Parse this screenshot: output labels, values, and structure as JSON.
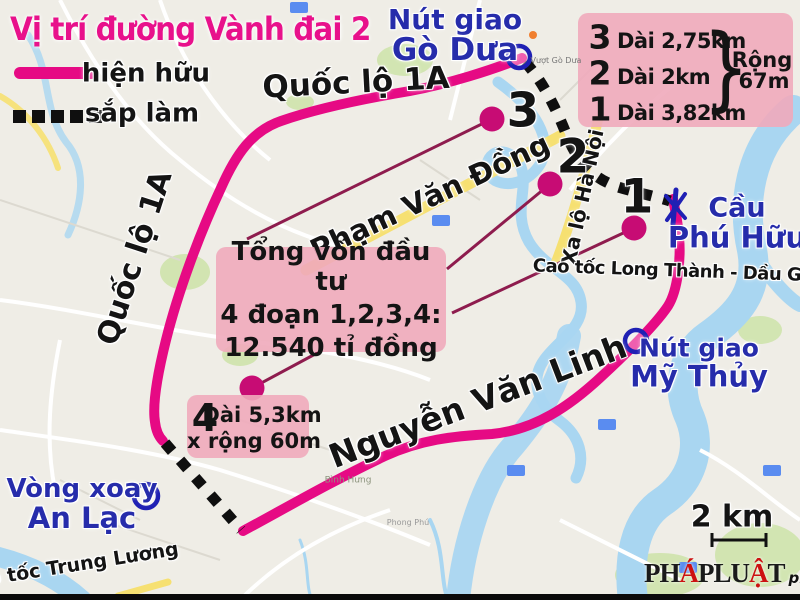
{
  "title": "Vị trí đường Vành đai 2",
  "legend": {
    "existing": "hiện hữu",
    "planned": "sắp làm"
  },
  "roads": {
    "ql1a_top": "Quốc lộ 1A",
    "ql1a_left": "Quốc lộ 1A",
    "pham_van_dong": "Phạm Văn Đồng",
    "xa_lo_ha_noi": "Xa lộ Hà Nội",
    "long_thanh": "Cao tốc Long Thành - Dầu Giây",
    "nguyen_van_linh": "Nguyễn Văn Linh",
    "trung_luong": "Cao tốc Trung Lương"
  },
  "junctions": {
    "go_dua": {
      "line1": "Nút giao",
      "line2": "Gò Dưa"
    },
    "my_thuy": {
      "line1": "Nút giao",
      "line2": "Mỹ Thủy"
    },
    "an_lac": {
      "line1": "Vòng xoay",
      "line2": "An Lạc"
    },
    "phu_huu": {
      "line1": "Cầu",
      "line2": "Phú Hữu"
    }
  },
  "segment_numbers": {
    "s1": "1",
    "s2": "2",
    "s3": "3"
  },
  "segment_box": {
    "rows": [
      {
        "num": "3",
        "len": "Dài 2,75km"
      },
      {
        "num": "2",
        "len": "Dài 2km"
      },
      {
        "num": "1",
        "len": "Dài 3,82km"
      }
    ],
    "brace": "}",
    "width_line1": "Rộng",
    "width_line2": "67m"
  },
  "investment_box": {
    "line1": "Tổng vốn đầu tư",
    "line2_a": "4 đoạn ",
    "line2_b": "1,2,3,4",
    "line2_c": ":",
    "line3": "12.540 tỉ đồng"
  },
  "segment4_box": {
    "num": "4",
    "line1": "Dài 5,3km",
    "line2": "x rộng 60m"
  },
  "scale": {
    "label": "2 km"
  },
  "logo": {
    "p1": "PH",
    "a1": "Á",
    "p2": "PLU",
    "a2": "Ậ",
    "p3": "T",
    "suffix": "plo.vn"
  },
  "map_labels": {
    "vuot_go_dua": "Vượt Gò Dưa",
    "binh_hung": "Bình Hưng",
    "phong_phu": "Phong Phú"
  },
  "colors": {
    "route_existing": "#e60a84",
    "route_planned": "#0f0f0f",
    "label_blue": "#262cab",
    "box_pink": "#f0aabb",
    "title_pink": "#e8118b",
    "leader": "#8e1c4e",
    "dot": "#c70c74",
    "water": "#a9d6f1",
    "park": "#cde3a8",
    "road_yellow": "#f6e071"
  }
}
